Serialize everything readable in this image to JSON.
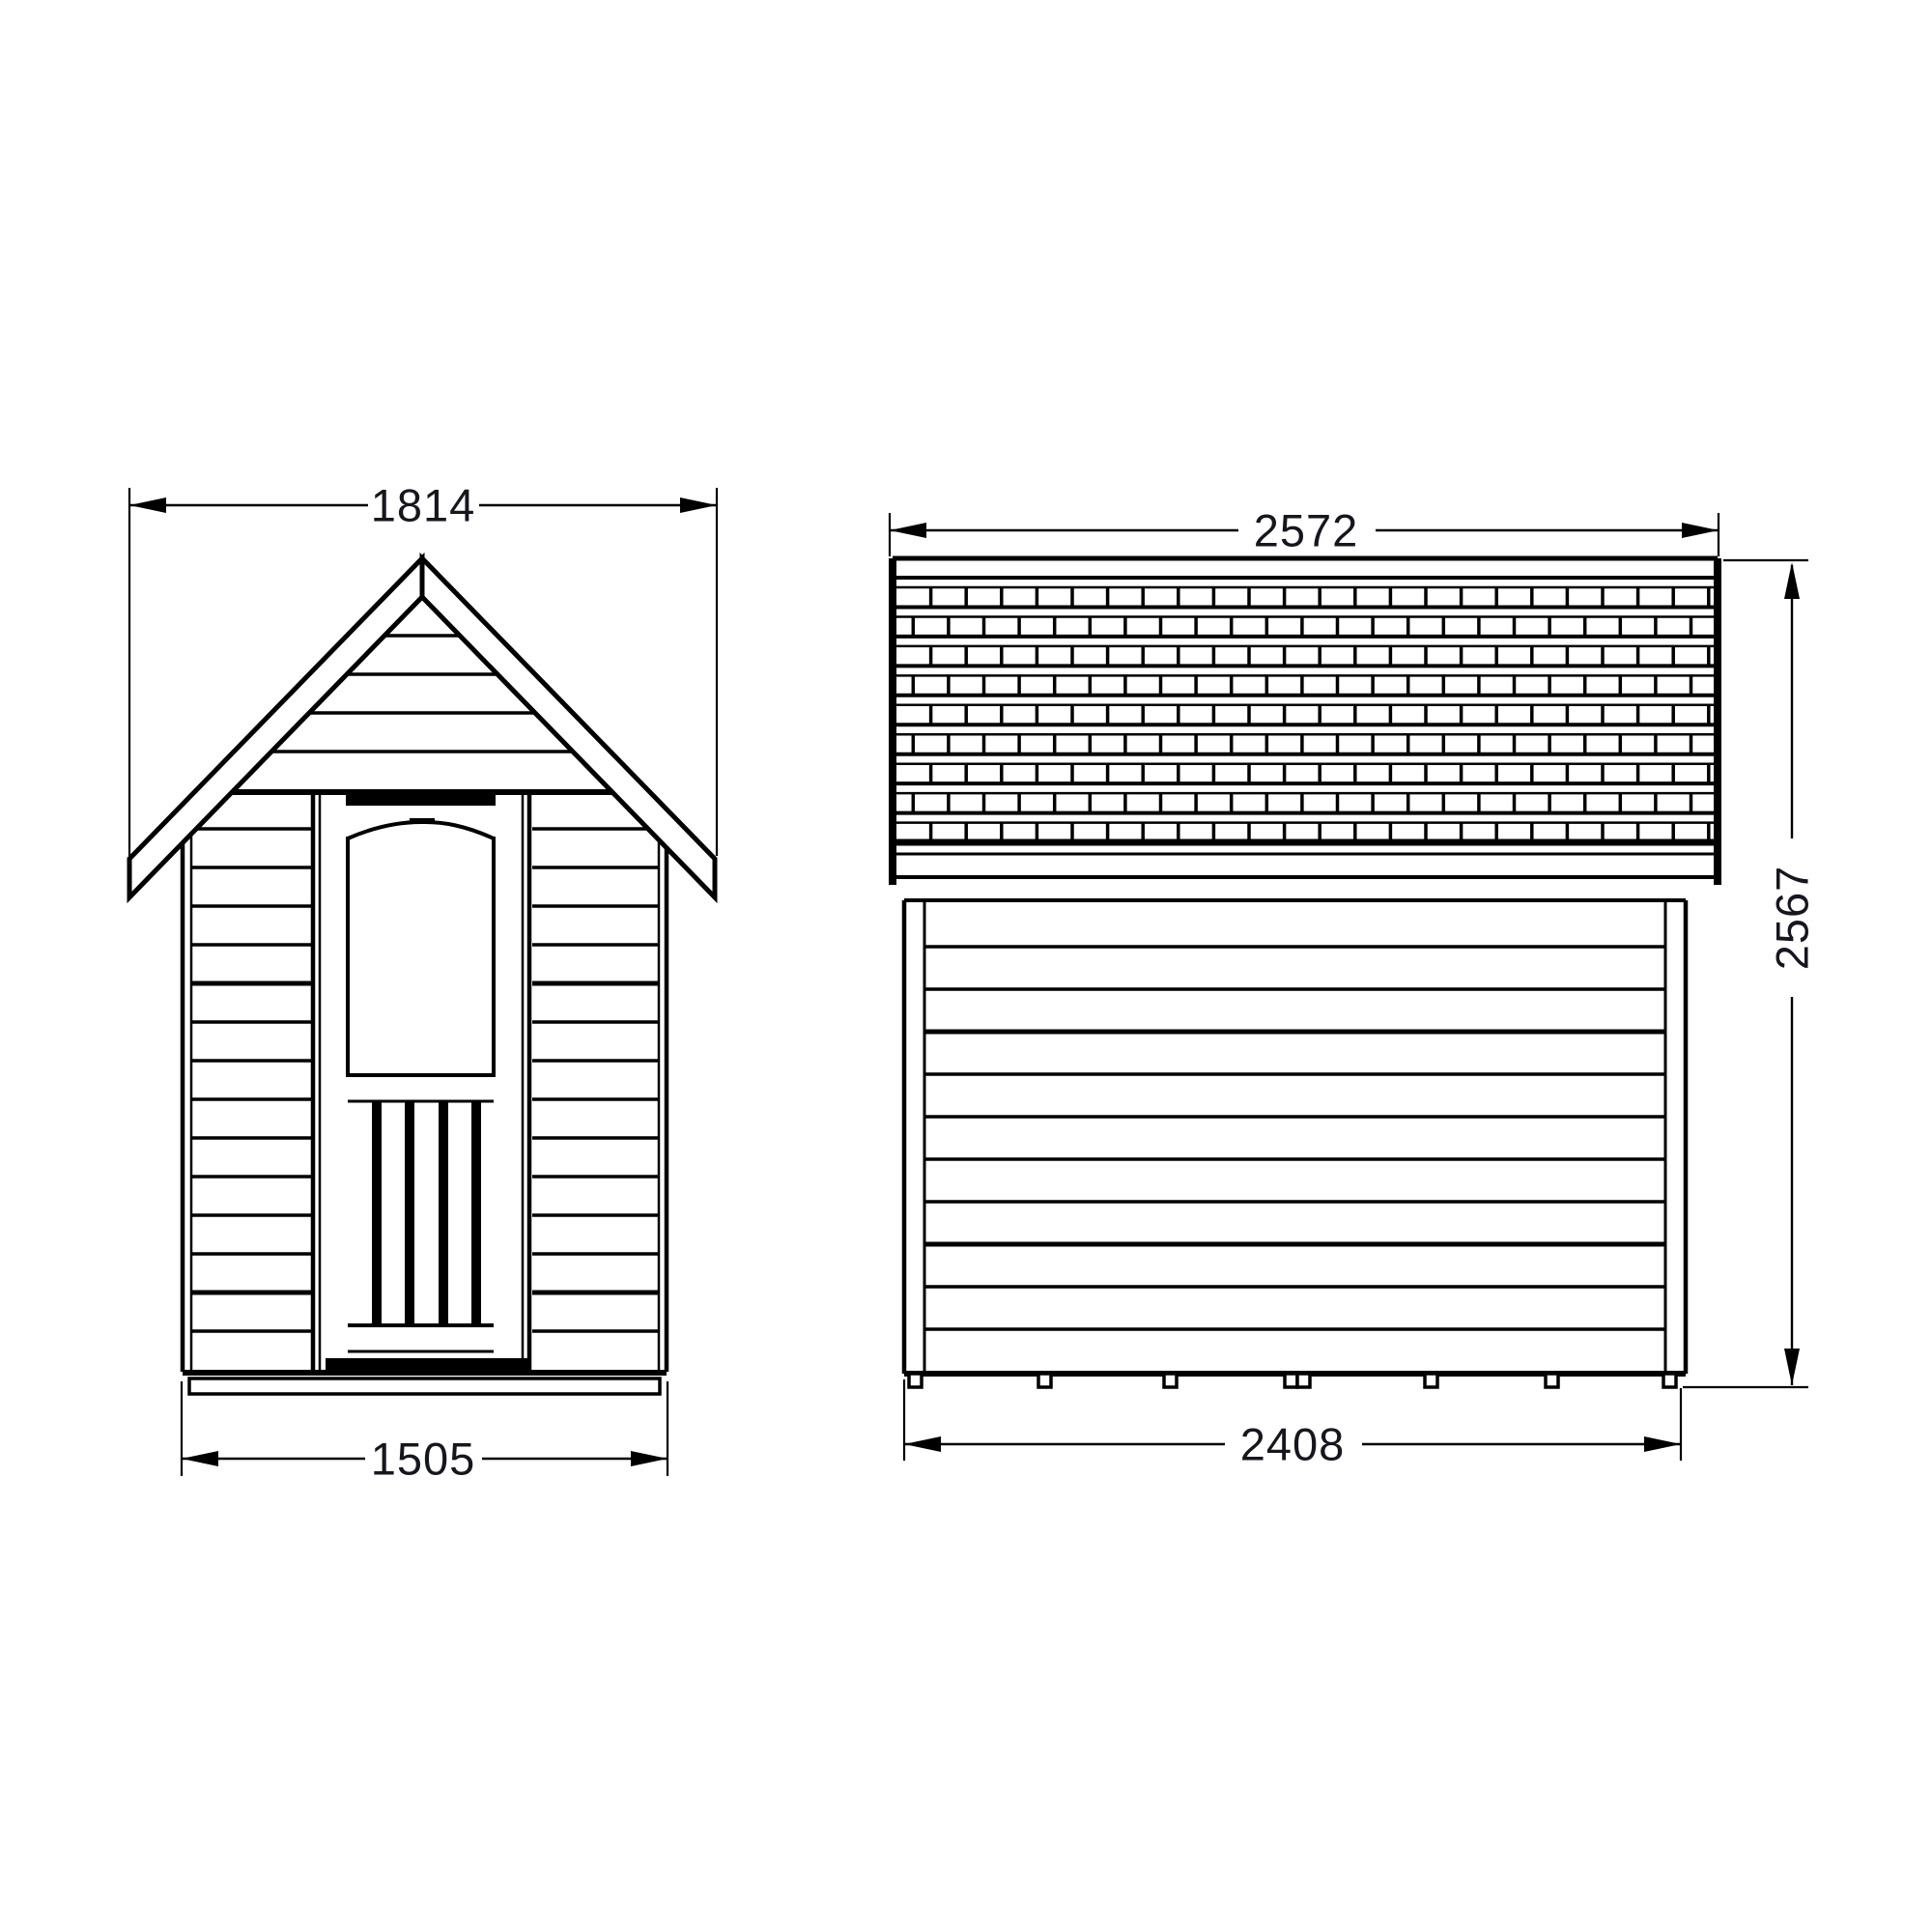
{
  "drawing": {
    "background_color": "#ffffff",
    "line_color": "#000000",
    "dimension_text_color": "#16161e",
    "views": {
      "front": {
        "dimensions": {
          "overall_width": "1814",
          "base_width": "1505"
        }
      },
      "side": {
        "dimensions": {
          "overall_depth": "2572",
          "base_depth": "2408",
          "overall_height": "2567"
        }
      }
    }
  }
}
